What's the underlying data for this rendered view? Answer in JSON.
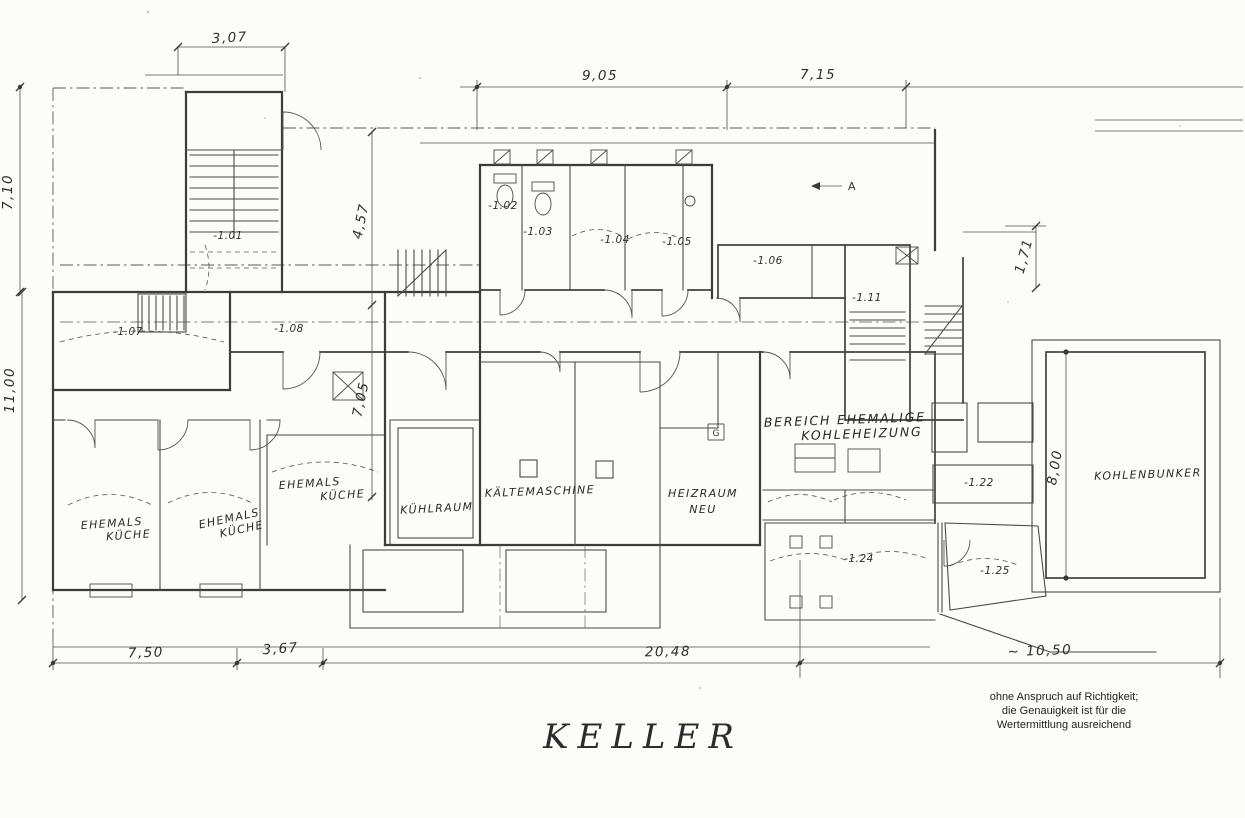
{
  "title": "KELLER",
  "disclaimer": {
    "l1": "ohne Anspruch auf Richtigkeit;",
    "l2": "die Genauigkeit ist für die",
    "l3": "Wertermittlung ausreichend"
  },
  "section_marker": {
    "label": "A"
  },
  "g_box": {
    "label": "G"
  },
  "dimensions": {
    "wing_width": "3,07",
    "top_mid": "9,05",
    "top_right": "7,15",
    "left_upper": "7,10",
    "left_lower": "11,00",
    "mid_upper": "4,57",
    "mid_lower": "7,05",
    "right_small": "1,71",
    "bunker_height": "8,00",
    "bottom_1": "7,50",
    "bottom_2": "3,67",
    "bottom_3": "20,48",
    "bottom_4": "~ 10,50"
  },
  "room_numbers": {
    "r101": "-1.01",
    "r102": "-1.02",
    "r103": "-1.03",
    "r104": "-1.04",
    "r105": "-1.05",
    "r106": "-1.06",
    "r107": "-1.07",
    "r108": "-1.08",
    "r111": "-1.11",
    "r122": "-1.22",
    "r124": "-1.24",
    "r125": "-1.25"
  },
  "room_labels": {
    "kueche1_l1": "EHEMALS",
    "kueche1_l2": "KÜCHE",
    "kueche2_l1": "EHEMALS",
    "kueche2_l2": "KÜCHE",
    "kueche3_l1": "EHEMALS",
    "kueche3_l2": "KÜCHE",
    "kuehlraum": "KÜHLRAUM",
    "kaeltemaschine": "KÄLTEMASCHINE",
    "heizraum_l1": "HEIZRAUM",
    "heizraum_l2": "NEU",
    "bereich_l1": "BEREICH EHEMALIGE",
    "bereich_l2": "KOHLEHEIZUNG",
    "kohlenbunker": "KOHLENBUNKER"
  }
}
